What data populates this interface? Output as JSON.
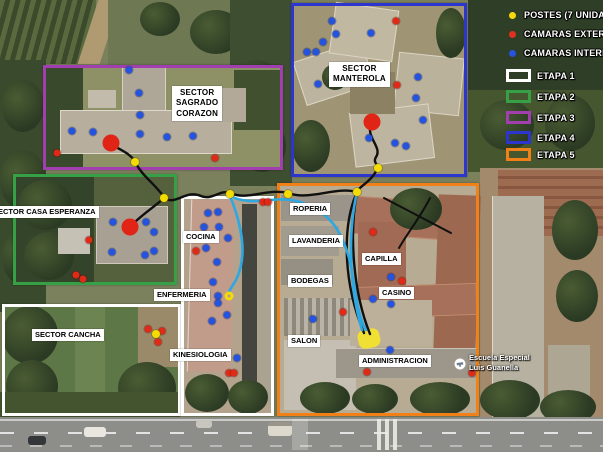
{
  "legend": {
    "items": [
      {
        "label": "POSTES (7 UNIDADES)",
        "swatch": "dot",
        "color": "#f5d90a"
      },
      {
        "label": "CAMARAS EXTERNAS",
        "swatch": "dot",
        "color": "#e0301e"
      },
      {
        "label": "CAMARAS INTERNAS",
        "swatch": "dot",
        "color": "#2453e0"
      },
      {
        "label": "ETAPA 1",
        "swatch": "rect",
        "color": "#ffffff"
      },
      {
        "label": "ETAPA 2",
        "swatch": "rect",
        "color": "#35a046"
      },
      {
        "label": "ETAPA 3",
        "swatch": "rect",
        "color": "#a23fb0"
      },
      {
        "label": "ETAPA 4",
        "swatch": "rect",
        "color": "#2d35cf"
      },
      {
        "label": "ETAPA 5",
        "swatch": "rect",
        "color": "#f28018"
      }
    ]
  },
  "zones": [
    {
      "name": "etapa-1-sector-cancha",
      "etapa": "ETAPA 1",
      "color": "#ffffff",
      "x": 2,
      "y": 304,
      "w": 179,
      "h": 112
    },
    {
      "name": "etapa-1-sector-central",
      "etapa": "ETAPA 1",
      "color": "#ffffff",
      "x": 181,
      "y": 196,
      "w": 93,
      "h": 220
    },
    {
      "name": "etapa-2-casa-esperanza",
      "etapa": "ETAPA 2",
      "color": "#35a046",
      "x": 13,
      "y": 174,
      "w": 164,
      "h": 111
    },
    {
      "name": "etapa-3-sagrado-corazon",
      "etapa": "ETAPA 3",
      "color": "#a23fb0",
      "x": 43,
      "y": 65,
      "w": 240,
      "h": 105
    },
    {
      "name": "etapa-4-manterola",
      "etapa": "ETAPA 4",
      "color": "#2d35cf",
      "x": 291,
      "y": 3,
      "w": 176,
      "h": 174
    },
    {
      "name": "etapa-5-administracion",
      "etapa": "ETAPA 5",
      "color": "#f28018",
      "x": 277,
      "y": 183,
      "w": 202,
      "h": 233
    }
  ],
  "labels": [
    {
      "name": "sector-sagrado-corazon",
      "text": "SECTOR SAGRADO\nCORAZON",
      "x": 172,
      "y": 86,
      "big": true
    },
    {
      "name": "sector-manterola",
      "text": "SECTOR\nMANTEROLA",
      "x": 329,
      "y": 62,
      "big": true
    },
    {
      "name": "sector-casa-esperanza",
      "text": "SECTOR CASA ESPERANZA",
      "x": -10,
      "y": 206
    },
    {
      "name": "sector-cancha",
      "text": "SECTOR CANCHA",
      "x": 32,
      "y": 329
    },
    {
      "name": "cocina",
      "text": "COCINA",
      "x": 183,
      "y": 231
    },
    {
      "name": "enfermeria",
      "text": "ENFERMERIA",
      "x": 154,
      "y": 289
    },
    {
      "name": "kinesiologia",
      "text": "KINESIOLOGIA",
      "x": 170,
      "y": 349
    },
    {
      "name": "roperia",
      "text": "ROPERIA",
      "x": 290,
      "y": 203
    },
    {
      "name": "lavanderia",
      "text": "LAVANDERIA",
      "x": 289,
      "y": 235
    },
    {
      "name": "capilla",
      "text": "CAPILLA",
      "x": 362,
      "y": 253
    },
    {
      "name": "bodegas",
      "text": "BODEGAS",
      "x": 288,
      "y": 275
    },
    {
      "name": "casino",
      "text": "CASINO",
      "x": 379,
      "y": 287
    },
    {
      "name": "salon",
      "text": "SALON",
      "x": 288,
      "y": 335
    },
    {
      "name": "administracion",
      "text": "ADMINISTRACION",
      "x": 359,
      "y": 355
    }
  ],
  "place": {
    "line1": "Escuela Especial",
    "line2": "Luis Guanella"
  },
  "markers": {
    "camaras_internas": [
      [
        129,
        70
      ],
      [
        139,
        93
      ],
      [
        140,
        115
      ],
      [
        72,
        131
      ],
      [
        93,
        132
      ],
      [
        140,
        134
      ],
      [
        167,
        137
      ],
      [
        193,
        136
      ],
      [
        332,
        21
      ],
      [
        336,
        34
      ],
      [
        371,
        33
      ],
      [
        323,
        42
      ],
      [
        307,
        52
      ],
      [
        316,
        52
      ],
      [
        318,
        84
      ],
      [
        418,
        77
      ],
      [
        416,
        98
      ],
      [
        423,
        120
      ],
      [
        369,
        138
      ],
      [
        395,
        143
      ],
      [
        406,
        146
      ],
      [
        113,
        222
      ],
      [
        146,
        222
      ],
      [
        154,
        232
      ],
      [
        112,
        252
      ],
      [
        145,
        255
      ],
      [
        154,
        251
      ],
      [
        208,
        213
      ],
      [
        218,
        212
      ],
      [
        204,
        227
      ],
      [
        219,
        227
      ],
      [
        228,
        238
      ],
      [
        206,
        248
      ],
      [
        217,
        262
      ],
      [
        213,
        282
      ],
      [
        218,
        296
      ],
      [
        218,
        303
      ],
      [
        227,
        315
      ],
      [
        212,
        321
      ],
      [
        237,
        358
      ],
      [
        391,
        277
      ],
      [
        373,
        299
      ],
      [
        391,
        304
      ],
      [
        313,
        319
      ],
      [
        390,
        350
      ]
    ],
    "camaras_externas": [
      [
        57,
        153
      ],
      [
        215,
        158
      ],
      [
        396,
        21
      ],
      [
        397,
        85
      ],
      [
        89,
        240
      ],
      [
        76,
        275
      ],
      [
        83,
        279
      ],
      [
        196,
        251
      ],
      [
        263,
        202
      ],
      [
        268,
        202
      ],
      [
        229,
        373
      ],
      [
        234,
        373
      ],
      [
        148,
        329
      ],
      [
        162,
        331
      ],
      [
        158,
        342
      ],
      [
        373,
        232
      ],
      [
        402,
        281
      ],
      [
        343,
        312
      ],
      [
        367,
        372
      ],
      [
        472,
        373
      ]
    ],
    "postes": [
      [
        135,
        162
      ],
      [
        164,
        198
      ],
      [
        230,
        194
      ],
      [
        288,
        194
      ],
      [
        357,
        192
      ],
      [
        378,
        168
      ],
      [
        156,
        334
      ]
    ],
    "nodos_rojos": [
      [
        111,
        143
      ],
      [
        372,
        122
      ],
      [
        130,
        227
      ]
    ],
    "anillo_amarillo": [
      229,
      296
    ],
    "zona_amarilla": {
      "x": 358,
      "y": 329,
      "w": 22,
      "h": 19
    }
  },
  "routes": [
    {
      "color": "#101010",
      "w": 2.4,
      "d": "M111,144 C120,150 128,152 135,161"
    },
    {
      "color": "#101010",
      "w": 2.4,
      "d": "M135,162 C143,177 154,183 164,197"
    },
    {
      "color": "#101010",
      "w": 2.4,
      "d": "M164,198 C176,206 186,189 201,196 C212,201 220,189 230,193"
    },
    {
      "color": "#101010",
      "w": 2.4,
      "d": "M230,193 C248,201 266,188 288,193"
    },
    {
      "color": "#101010",
      "w": 2.4,
      "d": "M288,193 C310,201 336,186 357,192"
    },
    {
      "color": "#101010",
      "w": 2.4,
      "d": "M372,123 C364,136 383,147 376,157 C373,162 377,164 378,167"
    },
    {
      "color": "#101010",
      "w": 2.4,
      "d": "M378,167 C373,180 363,184 357,191"
    },
    {
      "color": "#101010",
      "w": 2.4,
      "d": "M357,192 C341,228 344,286 364,333"
    },
    {
      "color": "#101010",
      "w": 2.4,
      "d": "M357,192 C349,234 353,292 370,334"
    },
    {
      "color": "#101010",
      "w": 2,
      "d": "M384,198 L451,233"
    },
    {
      "color": "#101010",
      "w": 2,
      "d": "M430,198 C420,218 408,232 399,248"
    },
    {
      "color": "#101010",
      "w": 2.4,
      "d": "M164,198 C153,208 140,216 131,226"
    },
    {
      "color": "#2fa8e2",
      "w": 2.6,
      "d": "M230,196 C243,228 247,258 236,280 C231,288 229,291 229,293"
    },
    {
      "color": "#2fa8e2",
      "w": 2.6,
      "d": "M230,196 C254,208 276,194 300,202 C330,212 341,230 349,258 C356,288 356,312 366,330"
    },
    {
      "color": "#2fa8e2",
      "w": 2.6,
      "d": "M357,192 C347,236 350,290 362,330"
    }
  ]
}
